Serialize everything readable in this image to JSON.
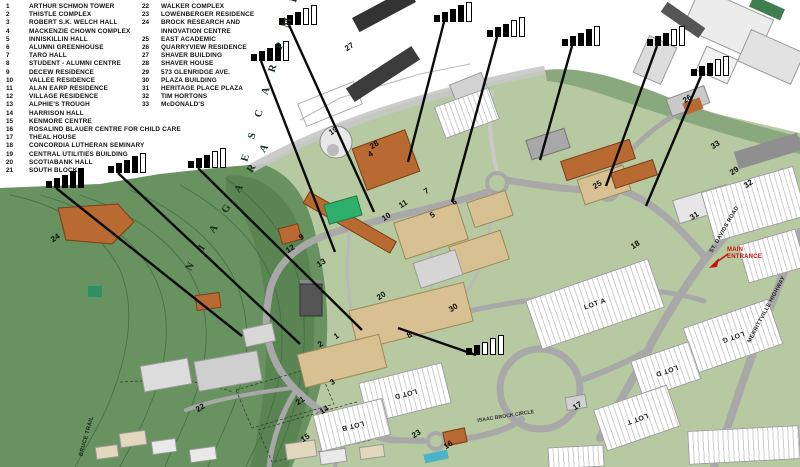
{
  "legend": {
    "column1": [
      {
        "num": "1",
        "label": "ARTHUR SCHMON TOWER"
      },
      {
        "num": "2",
        "label": "THISTLE COMPLEX"
      },
      {
        "num": "3",
        "label": "ROBERT S.K. WELCH HALL"
      },
      {
        "num": "4",
        "label": "MACKENZIE CHOWN COMPLEX"
      },
      {
        "num": "5",
        "label": "INNISKILLIN HALL"
      },
      {
        "num": "6",
        "label": "ALUMNI GREENHOUSE"
      },
      {
        "num": "7",
        "label": "TARO HALL"
      },
      {
        "num": "8",
        "label": "STUDENT - ALUMNI CENTRE"
      },
      {
        "num": "9",
        "label": "DECEW RESIDENCE"
      },
      {
        "num": "10",
        "label": "VALLEE RESIDENCE"
      },
      {
        "num": "11",
        "label": "ALAN EARP RESIDENCE"
      },
      {
        "num": "12",
        "label": "VILLAGE RESIDENCE"
      },
      {
        "num": "13",
        "label": "ALPHIE'S TROUGH"
      },
      {
        "num": "14",
        "label": "HARRISON HALL"
      },
      {
        "num": "15",
        "label": "KENMORE CENTRE"
      },
      {
        "num": "16",
        "label": "ROSALIND BLAUER CENTRE FOR CHILD CARE"
      },
      {
        "num": "17",
        "label": "THEAL HOUSE"
      },
      {
        "num": "18",
        "label": "CONCORDIA LUTHERAN SEMINARY"
      },
      {
        "num": "19",
        "label": "CENTRAL UTILITIES BUILDING"
      },
      {
        "num": "20",
        "label": "SCOTIABANK HALL"
      },
      {
        "num": "21",
        "label": "SOUTH BLOCK"
      }
    ],
    "column2": [
      {
        "num": "22",
        "label": "WALKER COMPLEX"
      },
      {
        "num": "23",
        "label": "LOWENBERGER RESIDENCE"
      },
      {
        "num": "24",
        "label": "BROCK RESEARCH AND",
        "label2": "INNOVATION CENTRE"
      },
      {
        "num": "25",
        "label": "EAST ACADEMIC"
      },
      {
        "num": "26",
        "label": "QUARRYVIEW RESIDENCE"
      },
      {
        "num": "27",
        "label": "SHAVER BUILDING"
      },
      {
        "num": "28",
        "label": "SHAVER HOUSE"
      },
      {
        "num": "29",
        "label": "573 GLENRIDGE AVE."
      },
      {
        "num": "30",
        "label": "PLAZA BUILDING"
      },
      {
        "num": "31",
        "label": "HERITAGE PLACE PLAZA"
      },
      {
        "num": "32",
        "label": "TIM HORTONS"
      },
      {
        "num": "33",
        "label": "McDONALD'S"
      }
    ]
  },
  "map": {
    "colors": {
      "campus_green": "#b7c9a0",
      "escarpment_green": "#68925f",
      "escarpment_dark": "#4f7a49",
      "band_green": "#8aa87e",
      "road_gray": "#a8a8a8",
      "building_tan": "#d7c193",
      "building_orange": "#b96a32",
      "building_gray": "#d9d9d9",
      "tower_gray": "#555555",
      "accent_green": "#2eaf6b",
      "marker_black": "#0a0a0a",
      "entrance_red": "#cc1111",
      "pool_teal": "#4ab3c9",
      "contour_green": "#3d6b3f"
    },
    "signal_markers": [
      {
        "bars_filled": 5,
        "bars_total": 5,
        "x": 46,
        "y": 167,
        "line_to": [
          242,
          336
        ]
      },
      {
        "bars_filled": 4,
        "bars_total": 5,
        "x": 108,
        "y": 152,
        "line_to": [
          300,
          344
        ]
      },
      {
        "bars_filled": 3,
        "bars_total": 5,
        "x": 188,
        "y": 147,
        "line_to": [
          362,
          330
        ]
      },
      {
        "bars_filled": 4,
        "bars_total": 5,
        "x": 251,
        "y": 40,
        "line_to": [
          335,
          252
        ]
      },
      {
        "bars_filled": 3,
        "bars_total": 5,
        "x": 279,
        "y": 4,
        "line_to": [
          374,
          212
        ]
      },
      {
        "bars_filled": 4,
        "bars_total": 5,
        "x": 434,
        "y": 1,
        "line_to": [
          408,
          162
        ]
      },
      {
        "bars_filled": 3,
        "bars_total": 5,
        "x": 487,
        "y": 16,
        "line_to": [
          452,
          202
        ]
      },
      {
        "bars_filled": 4,
        "bars_total": 5,
        "x": 562,
        "y": 25,
        "line_to": [
          540,
          160
        ]
      },
      {
        "bars_filled": 3,
        "bars_total": 5,
        "x": 647,
        "y": 25,
        "line_to": [
          606,
          186
        ]
      },
      {
        "bars_filled": 3,
        "bars_total": 5,
        "x": 691,
        "y": 55,
        "line_to": [
          646,
          206
        ]
      },
      {
        "bars_filled": 2,
        "bars_total": 5,
        "x": 466,
        "y": 334,
        "line_to": [
          398,
          328
        ]
      }
    ],
    "building_numbers": [
      {
        "num": "27",
        "x": 348,
        "y": 52
      },
      {
        "num": "26",
        "x": 686,
        "y": 104
      },
      {
        "num": "25",
        "x": 596,
        "y": 190
      },
      {
        "num": "29",
        "x": 733,
        "y": 176
      },
      {
        "num": "32",
        "x": 747,
        "y": 189
      },
      {
        "num": "31",
        "x": 693,
        "y": 221
      },
      {
        "num": "30",
        "x": 452,
        "y": 313
      },
      {
        "num": "24",
        "x": 54,
        "y": 243
      },
      {
        "num": "19",
        "x": 332,
        "y": 136
      },
      {
        "num": "28",
        "x": 373,
        "y": 150
      },
      {
        "num": "10",
        "x": 385,
        "y": 222
      },
      {
        "num": "11",
        "x": 402,
        "y": 209
      },
      {
        "num": "5",
        "x": 433,
        "y": 219
      },
      {
        "num": "6",
        "x": 455,
        "y": 206
      },
      {
        "num": "7",
        "x": 427,
        "y": 195
      },
      {
        "num": "4",
        "x": 371,
        "y": 158
      },
      {
        "num": "9",
        "x": 302,
        "y": 241
      },
      {
        "num": "12",
        "x": 289,
        "y": 254
      },
      {
        "num": "13",
        "x": 320,
        "y": 268
      },
      {
        "num": "1",
        "x": 337,
        "y": 340
      },
      {
        "num": "2",
        "x": 321,
        "y": 348
      },
      {
        "num": "3",
        "x": 333,
        "y": 386
      },
      {
        "num": "8",
        "x": 410,
        "y": 339
      },
      {
        "num": "14",
        "x": 323,
        "y": 415
      },
      {
        "num": "15",
        "x": 304,
        "y": 443
      },
      {
        "num": "16",
        "x": 447,
        "y": 450
      },
      {
        "num": "17",
        "x": 576,
        "y": 411
      },
      {
        "num": "18",
        "x": 634,
        "y": 250
      },
      {
        "num": "20",
        "x": 380,
        "y": 301
      },
      {
        "num": "21",
        "x": 299,
        "y": 406
      },
      {
        "num": "22",
        "x": 199,
        "y": 413
      },
      {
        "num": "23",
        "x": 415,
        "y": 439
      },
      {
        "num": "33",
        "x": 714,
        "y": 150
      }
    ],
    "labels": [
      {
        "text": "N I A G A R A",
        "x": 193,
        "y": 272,
        "rot": -58,
        "cls": "esc"
      },
      {
        "text": "E S C A R P M E N T",
        "x": 250,
        "y": 162,
        "rot": -73,
        "cls": "esc"
      },
      {
        "text": "ST. DAVIDS ROAD",
        "x": 714,
        "y": 258,
        "rot": -60,
        "cls": "road"
      },
      {
        "text": "MERRITTVILLE HIGHWAY",
        "x": 752,
        "y": 348,
        "rot": -62,
        "cls": "road"
      },
      {
        "text": "ISAAC BROCK CIRCLE",
        "x": 478,
        "y": 428,
        "rot": -9,
        "cls": "circle"
      },
      {
        "text": "BRUCE TRAIL",
        "x": 84,
        "y": 461,
        "rot": -74,
        "cls": "road"
      }
    ],
    "main_entrance": {
      "line1": "MAIN",
      "line2": "ENTRANCE",
      "x": 727,
      "y": 247
    },
    "lots": [
      {
        "label": "LOT A",
        "x": 530,
        "y": 278,
        "w": 130,
        "h": 52,
        "rot": -19,
        "flip": false
      },
      {
        "label": "LOT G",
        "x": 688,
        "y": 312,
        "w": 90,
        "h": 48,
        "rot": -19,
        "flip": true
      },
      {
        "label": "LOT D",
        "x": 635,
        "y": 350,
        "w": 62,
        "h": 40,
        "rot": -19,
        "flip": true
      },
      {
        "label": "LOT T",
        "x": 598,
        "y": 396,
        "w": 78,
        "h": 44,
        "rot": -19,
        "flip": true
      },
      {
        "label": "LOT D",
        "x": 362,
        "y": 372,
        "w": 86,
        "h": 42,
        "rot": -14,
        "flip": true
      },
      {
        "label": "LOT B",
        "x": 316,
        "y": 406,
        "w": 72,
        "h": 38,
        "rot": -14,
        "flip": true
      },
      {
        "label": "",
        "x": 706,
        "y": 178,
        "w": 96,
        "h": 52,
        "rot": -16,
        "flip": false
      },
      {
        "label": "",
        "x": 742,
        "y": 236,
        "w": 60,
        "h": 40,
        "rot": -16,
        "flip": false
      },
      {
        "label": "",
        "x": 688,
        "y": 428,
        "w": 112,
        "h": 34,
        "rot": -3,
        "flip": false
      },
      {
        "label": "",
        "x": 548,
        "y": 446,
        "w": 56,
        "h": 22,
        "rot": -3,
        "flip": false
      },
      {
        "label": "",
        "x": 438,
        "y": 96,
        "w": 58,
        "h": 34,
        "rot": -20,
        "flip": false
      }
    ]
  }
}
